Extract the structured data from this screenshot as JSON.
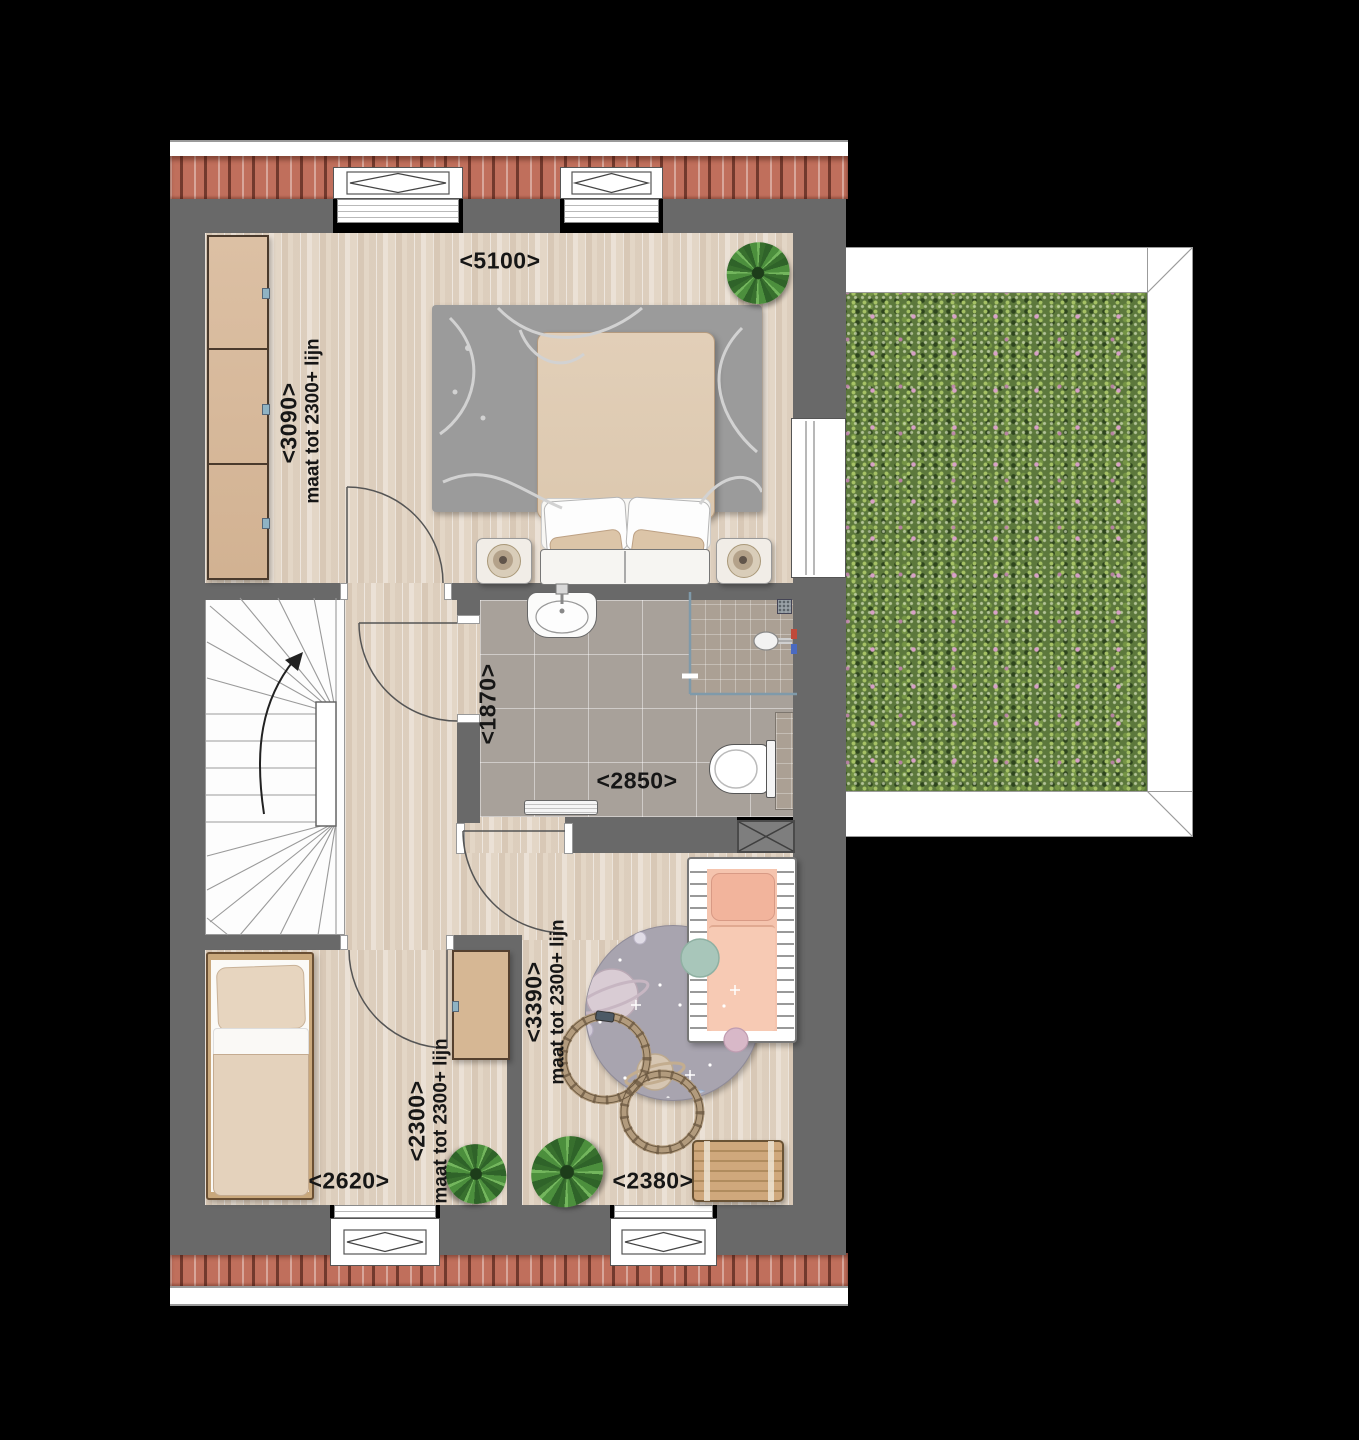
{
  "floorplan": {
    "master_bedroom": {
      "width": "<5100>",
      "depth": "<3090>",
      "ceiling_note": "maat tot 2300+ lijn"
    },
    "bathroom": {
      "depth": "<1870>",
      "width": "<2850>"
    },
    "bedroom_2": {
      "width": "<2620>",
      "depth": "<2300>",
      "ceiling_note": "maat tot 2300+ lijn"
    },
    "bedroom_3": {
      "depth": "<3390>",
      "ceiling_note": "maat tot 2300+ lijn",
      "width": "<2380>"
    },
    "colors": {
      "wall": "#696969",
      "roof_tile": "#c06f5c",
      "sedum_green": "#5c783c",
      "wood_floor": "#e3d6c6",
      "bath_tile": "#a8a19a",
      "crib_pink": "#f5c4ae"
    }
  }
}
